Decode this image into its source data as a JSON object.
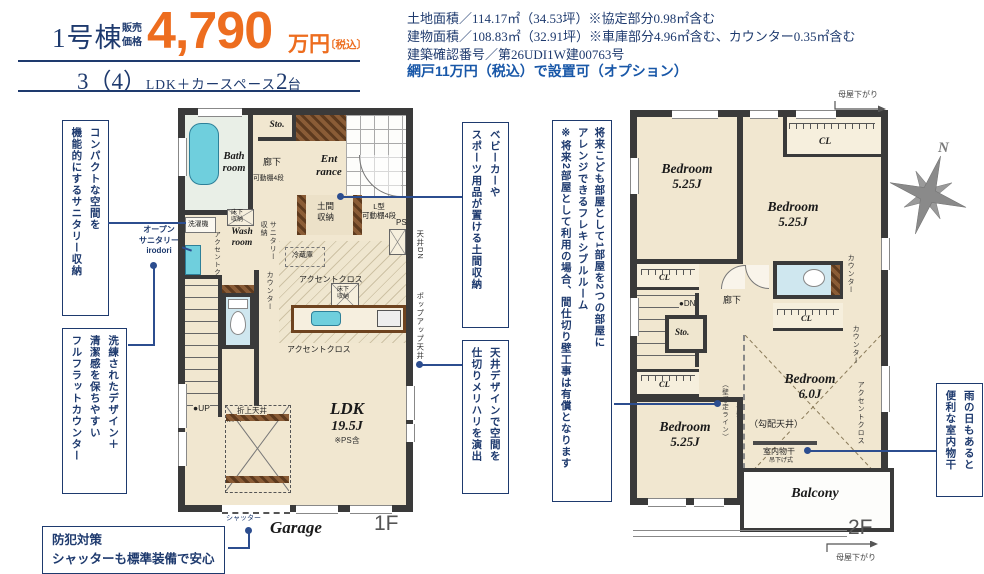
{
  "header": {
    "building": "1号棟",
    "price_caption": "販売\n価格",
    "price": "4,790",
    "price_unit": "万円",
    "price_tax": "〔税込〕",
    "layout_num": "3（4）",
    "layout_text": "LDK＋カースペース",
    "layout_count": "2",
    "layout_count_unit": "台"
  },
  "details": {
    "land": "土地面積／114.17㎡（34.53坪）※協定部分0.98㎡含む",
    "building": "建物面積／108.83㎡（32.91坪）※車庫部分4.96㎡含む、カウンター0.35㎡含む",
    "confirmation": "建築確認番号／第26UDI1W建00763号",
    "option": "網戸11万円（税込）で設置可（オプション）"
  },
  "callouts": {
    "sanitary": "コンパクトな空間を\n機能的にするサニタリー収納",
    "open_sanitary": "オープン\nサニタリー\nirodori",
    "counter": "洗練されたデザイン＋\n清潔感を保ちやすい\nフルフラットカウンター",
    "security": "防犯対策\nシャッターも標準装備で安心",
    "doma": "ベビーカーや\nスポーツ用品が置ける土間収納",
    "ceiling": "天井デザインで空間を\n仕切りメリハリを演出",
    "flexible": "将来こども部屋として1部屋を2つの部屋に\nアレンジできるフレキシブルルーム\n※将来2部屋として利用の場合、間仕切り壁工事は有償となります",
    "laundry": "雨の日もあると\n便利な室内物干"
  },
  "floor1": {
    "label": "1F",
    "bath": "Bath\nroom",
    "sto": "Sto.",
    "hall1": "廊下",
    "shelf": "可動棚4段",
    "entrance": "Ent\nrance",
    "doma": "土間\n収納",
    "l_shelf": "L型\n可動棚4段",
    "ps": "PS",
    "ceiling_dn": "天井DN",
    "washer": "洗濯機",
    "underfloor": "床下\n収納",
    "wash": "Wash\nroom",
    "accent_v": "アクセントクロス",
    "sanitary_v": "サニタリー\n収納",
    "counter_v": "カウンター",
    "fridge": "冷蔵庫",
    "accent1": "アクセントクロス",
    "popup": "ポップアップ天井",
    "accent2": "アクセントクロス",
    "up": "●UP",
    "hall2": "廊下",
    "ldk": "LDK",
    "ldk_size": "19.5J",
    "ldk_note": "※PS含",
    "oriage": "折上天井",
    "garage": "Garage",
    "shutter": "シャッター"
  },
  "floor2": {
    "label": "2F",
    "bedroom": "Bedroom",
    "bed1_size": "5.25J",
    "bed2_size": "5.25J",
    "bed3_size": "6.0J",
    "bed3_note": "（勾配天井）",
    "bed4_size": "5.25J",
    "cl": "CL",
    "dn": "●DN",
    "hall": "廊下",
    "sto": "Sto.",
    "wall_line": "（壁想定ライン）",
    "tarekabe": "垂壁",
    "monohoshi": "室内物干",
    "tsurisage": "吊下げ式",
    "balcony": "Balcony",
    "counter1": "カウンター",
    "counter2": "カウンター",
    "accent": "アクセントクロス",
    "moya_top": "母屋下がり",
    "moya_bottom": "母屋下がり",
    "north": "N"
  }
}
